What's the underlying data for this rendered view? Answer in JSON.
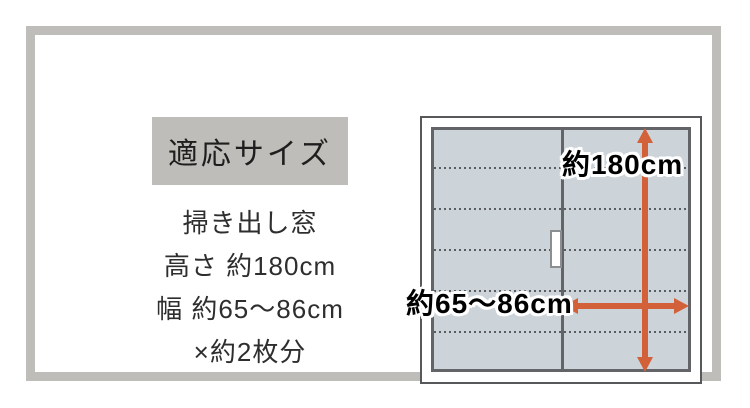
{
  "panel": {
    "title": "適応サイズ",
    "lines": [
      "掃き出し窓",
      "高さ 約180cm",
      "幅 約65～86cm",
      "×約2枚分"
    ]
  },
  "diagram": {
    "height_label": "約180cm",
    "width_label": "約65～86cm"
  },
  "colors": {
    "frame_gray": "#bfbdb9",
    "glass_fill": "#ccd3d9",
    "window_border": "#57585a",
    "glass_border": "#636468",
    "arrow_orange": "#d2613a",
    "text": "#2e2e2e"
  }
}
